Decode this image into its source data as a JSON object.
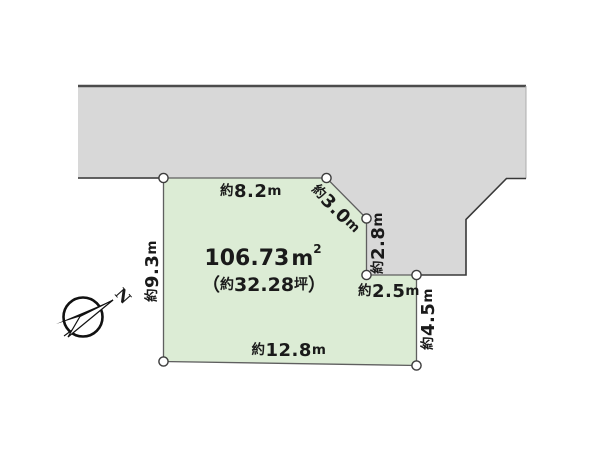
{
  "diagram": {
    "colors": {
      "road_fill": "#d8d8d8",
      "plot_fill": "#dcecd5",
      "outline_dark": "#4c4c4c",
      "plot_outline": "#5f5f5f",
      "text": "#1a1a1a",
      "vertex_fill": "#ffffff"
    },
    "area": {
      "value": "106.73",
      "unit_base": "m",
      "unit_exponent": "2"
    },
    "tsubo": {
      "open": "（",
      "prefix": "約",
      "value": "32.28",
      "unit": "坪",
      "close": "）"
    },
    "edges": {
      "top": {
        "prefix": "約",
        "value": "8.2",
        "unit": "m"
      },
      "diagonal": {
        "prefix": "約",
        "value": "3.0",
        "unit": "m"
      },
      "right_upper": {
        "prefix": "約",
        "value": "2.8",
        "unit": "m"
      },
      "step": {
        "prefix": "約",
        "value": "2.5",
        "unit": "m"
      },
      "right_lower": {
        "prefix": "約",
        "value": "4.5",
        "unit": "m"
      },
      "left": {
        "prefix": "約",
        "value": "9.3",
        "unit": "m"
      },
      "bottom": {
        "prefix": "約",
        "value": "12.8",
        "unit": "m"
      }
    },
    "compass": {
      "north_label": "N"
    }
  }
}
